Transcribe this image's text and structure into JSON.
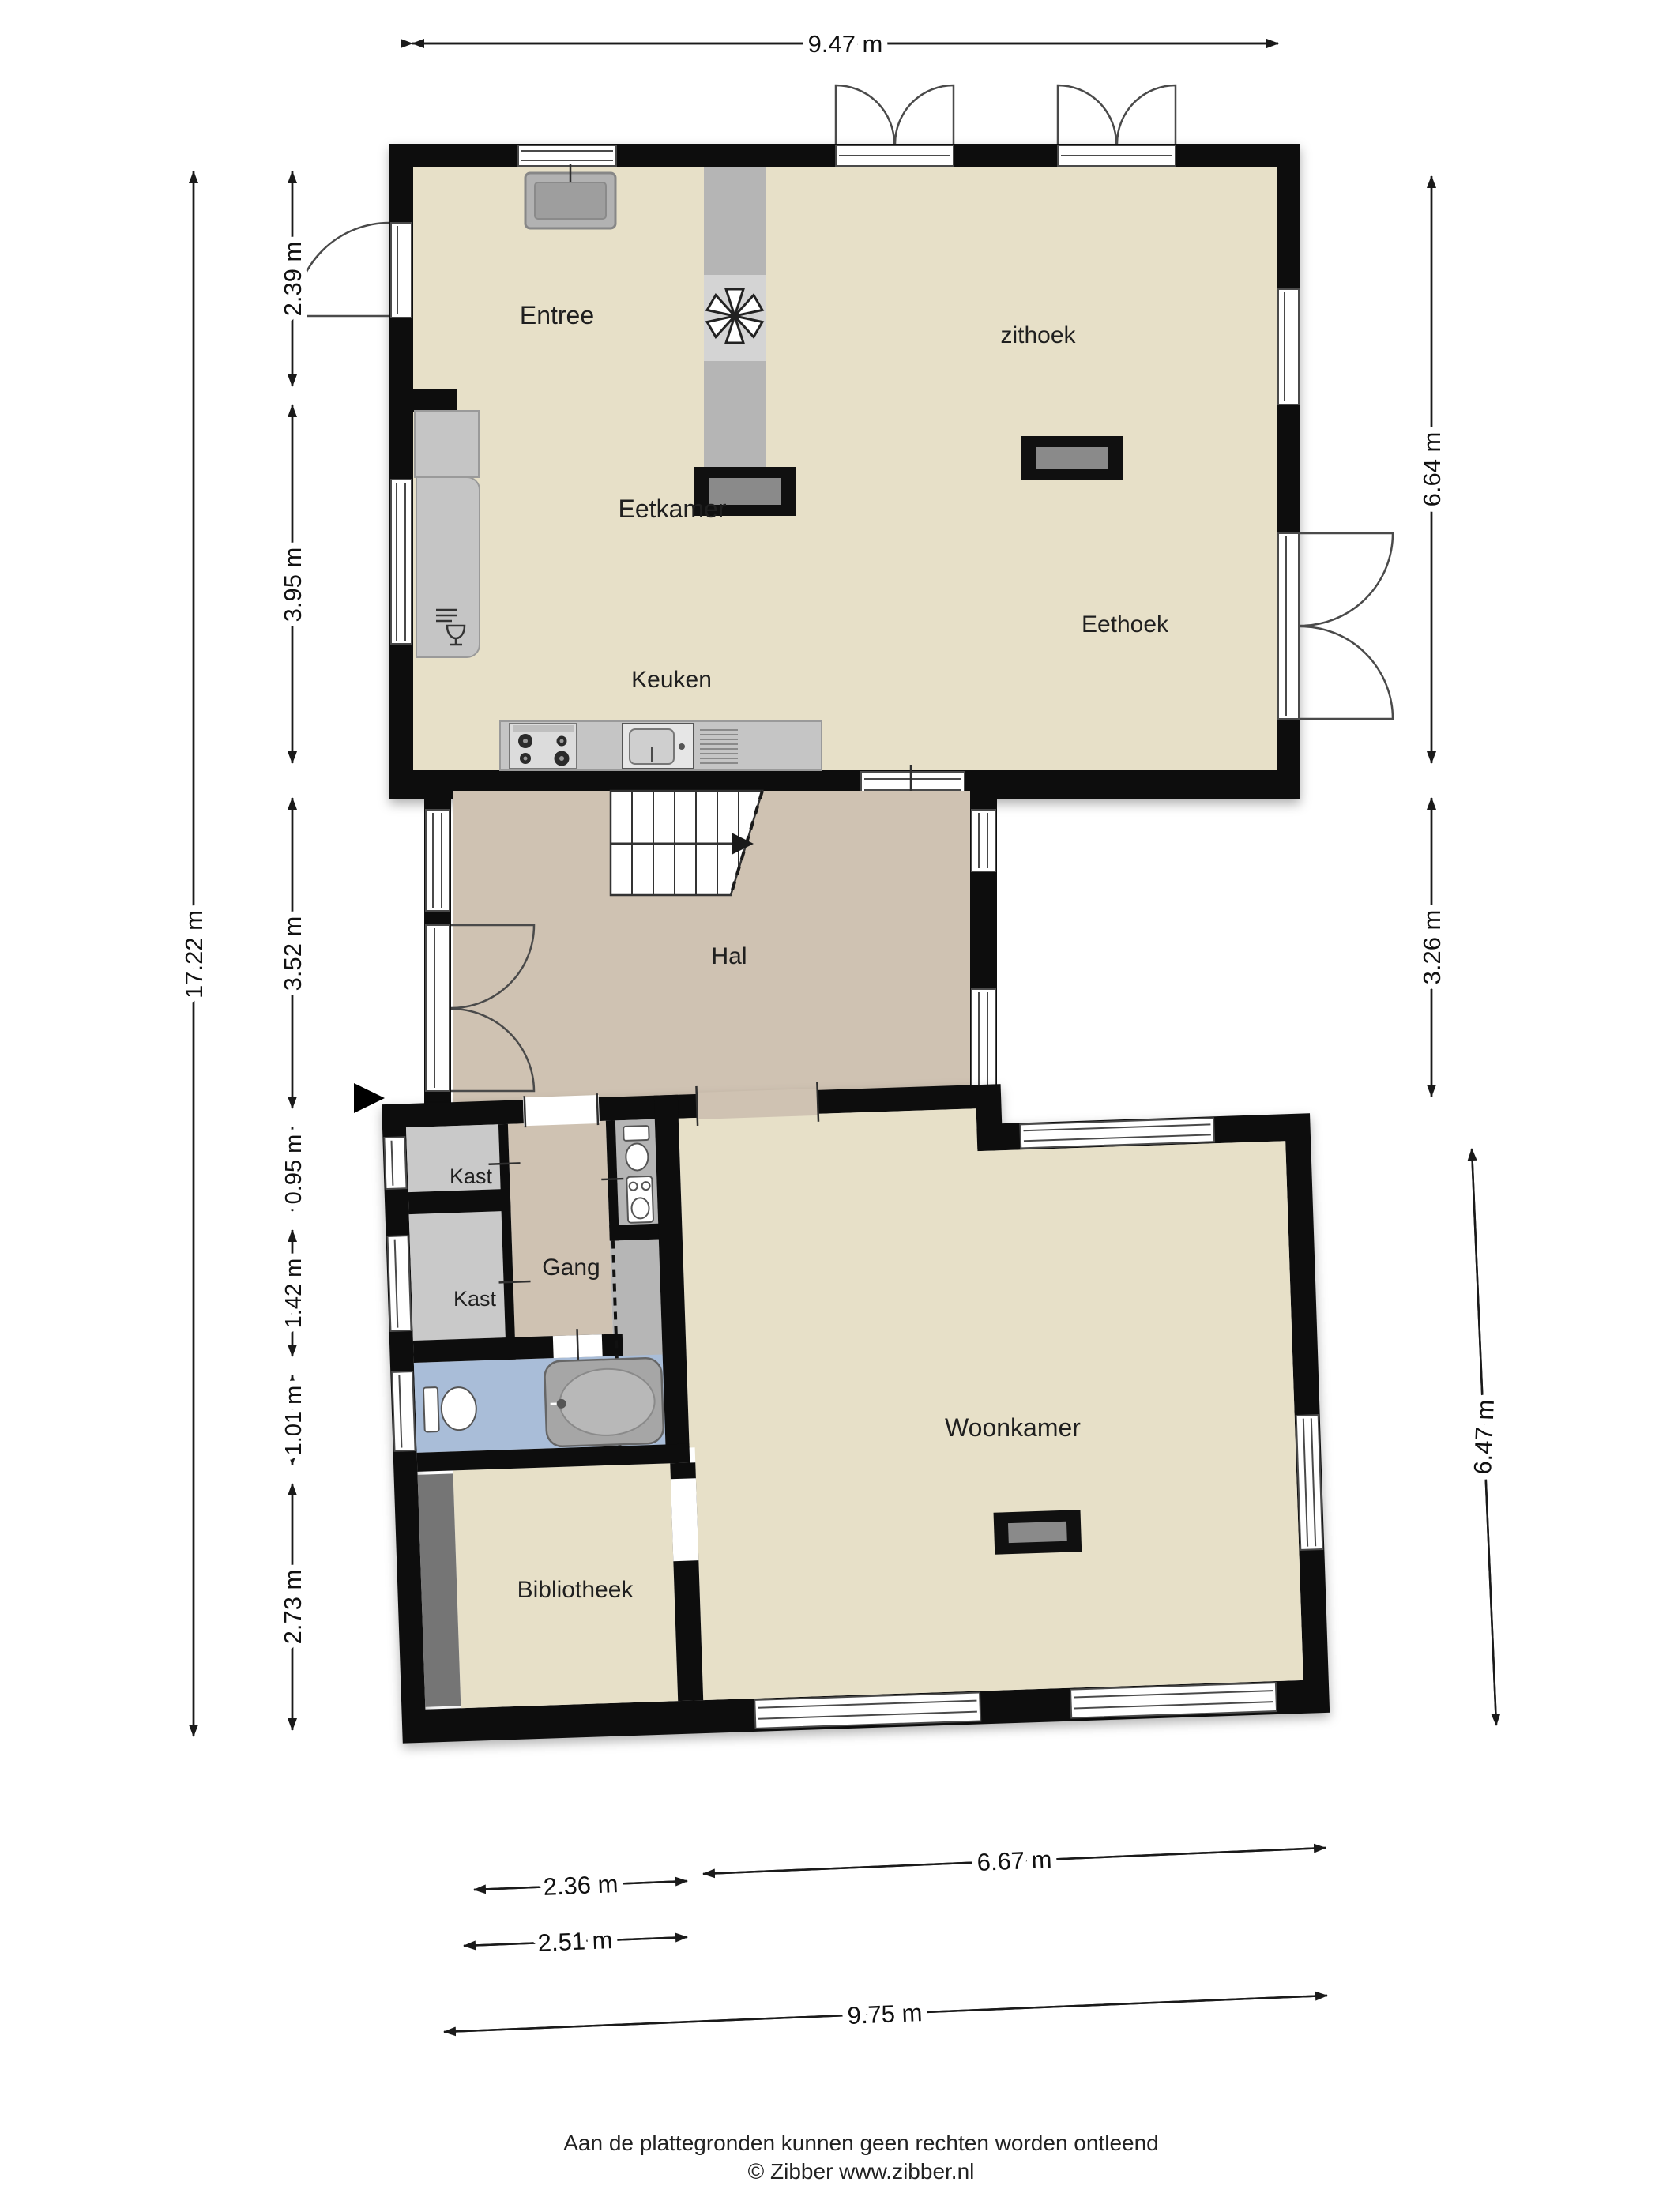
{
  "plan": {
    "rooms": {
      "entree": "Entree",
      "zithoek": "zithoek",
      "eetkamer": "Eetkamer",
      "eethoek": "Eethoek",
      "keuken": "Keuken",
      "hal": "Hal",
      "kast1": "Kast",
      "kast2": "Kast",
      "gang": "Gang",
      "woonkamer": "Woonkamer",
      "bibliotheek": "Bibliotheek"
    },
    "dimensions": {
      "top": "9.47 m",
      "left_total": "17.22 m",
      "left": [
        "2.39 m",
        "3.95 m",
        "3.52 m",
        "0.95 m",
        "1.42 m",
        "1.01 m",
        "2.73 m"
      ],
      "right": [
        "6.64 m",
        "3.26 m",
        "6.47 m"
      ],
      "bottom": [
        "2.36 m",
        "6.67 m",
        "2.51 m",
        "9.75 m"
      ]
    },
    "colors": {
      "wall": "#0d0d0d",
      "floor_living": "#e7e0c8",
      "floor_hall": "#cfc2b2",
      "floor_closet": "#c9c9c9",
      "floor_bathroom": "#a9bdd8",
      "furniture": "#b2b2b2",
      "counter": "#c5c5c5",
      "bookcase": "#757575"
    }
  },
  "footer": {
    "line1": "Aan de plattegronden kunnen geen rechten worden ontleend",
    "line2": "© Zibber www.zibber.nl"
  }
}
